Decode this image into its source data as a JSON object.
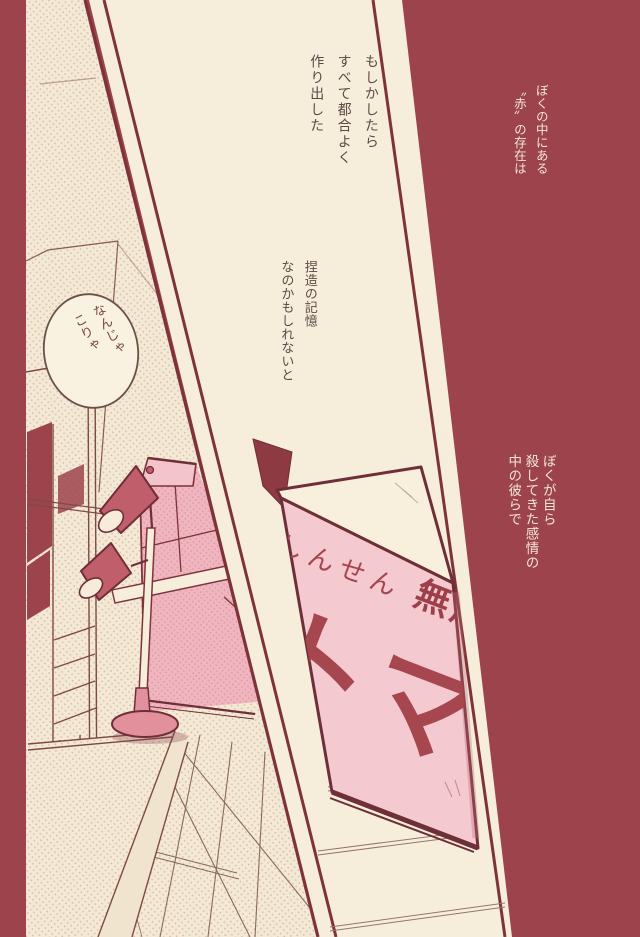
{
  "page": {
    "background_color": "#9d434c",
    "panel_color": "#f6eedb",
    "pink_color": "#f4c9cf",
    "ink_color": "#7e333b"
  },
  "narration": {
    "top_center": [
      "もしかしたら",
      "すべて都合よく",
      "作り出した"
    ],
    "top_right": [
      "ぼくの中にある",
      "〝赤〟の存在は"
    ],
    "middle_center": [
      "捏造の記憶",
      "なのかもしれないと"
    ],
    "middle_right": [
      "ぼくが自ら",
      "殺してきた感情の",
      "中の彼らで"
    ]
  },
  "speech_bubble": [
    "なんじゃ",
    "こりゃ"
  ],
  "tomato_box": {
    "label_fresh": "しんせん",
    "label_organic": "無農",
    "label_product": "トマ"
  }
}
